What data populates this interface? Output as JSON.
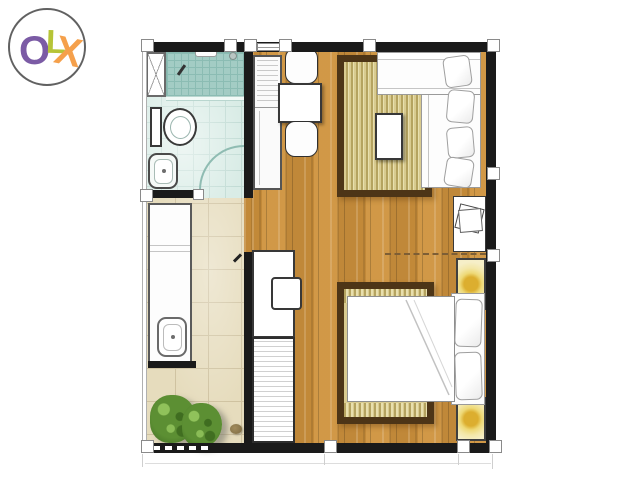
{
  "logo": {
    "brand": "OLX",
    "letters": [
      {
        "char": "O"
      },
      {
        "char": "L"
      },
      {
        "char": "X"
      }
    ]
  },
  "floorplan": {
    "type": "studio-apartment-floor-plan",
    "rooms": [
      "bathroom",
      "kitchen-walkway",
      "living-sleeping-room"
    ],
    "items": [
      "shower-area",
      "shower-shelf",
      "shower-drain",
      "bathroom-cabinet",
      "toilet",
      "bathroom-sink",
      "door-swing-arc",
      "kitchen-counter",
      "kitchen-sink",
      "plants",
      "pebble",
      "storage-cabinet",
      "dining-table",
      "dining-chairs",
      "area-rug-top",
      "coffee-table",
      "daybed-sofa",
      "sofa-pillows",
      "side-table",
      "papers",
      "dashed-partition-line",
      "bedside-lamps",
      "area-rug-bottom",
      "double-bed",
      "bed-pillows",
      "desk",
      "desk-chair",
      "wardrobe",
      "column-markers"
    ]
  },
  "theme": {
    "wall": "#1a1a1a",
    "outline": "#8a8a8a",
    "logo-o": "#7b5ba5",
    "logo-l": "#b6c437",
    "logo-x": "#f5a04b",
    "wood-base": "#cc923f",
    "tile-beige": "#e6dcbd",
    "tile-line": "#cfc2a0",
    "teal-floor": "#d9ece6",
    "teal-grid": "#c2dcd5",
    "shower": "#a3ccc4",
    "shower-grid": "#8bbcb3",
    "rug-border": "#4d3517",
    "rug-a": "#d9cb90",
    "rug-b": "#b5a360",
    "rug-c": "#e8dfae",
    "lamp-bg": "#f6efc8",
    "lamp-glow": "#dcae2f",
    "plant": "#5c8f33",
    "plant-dark": "#3f6b22"
  }
}
